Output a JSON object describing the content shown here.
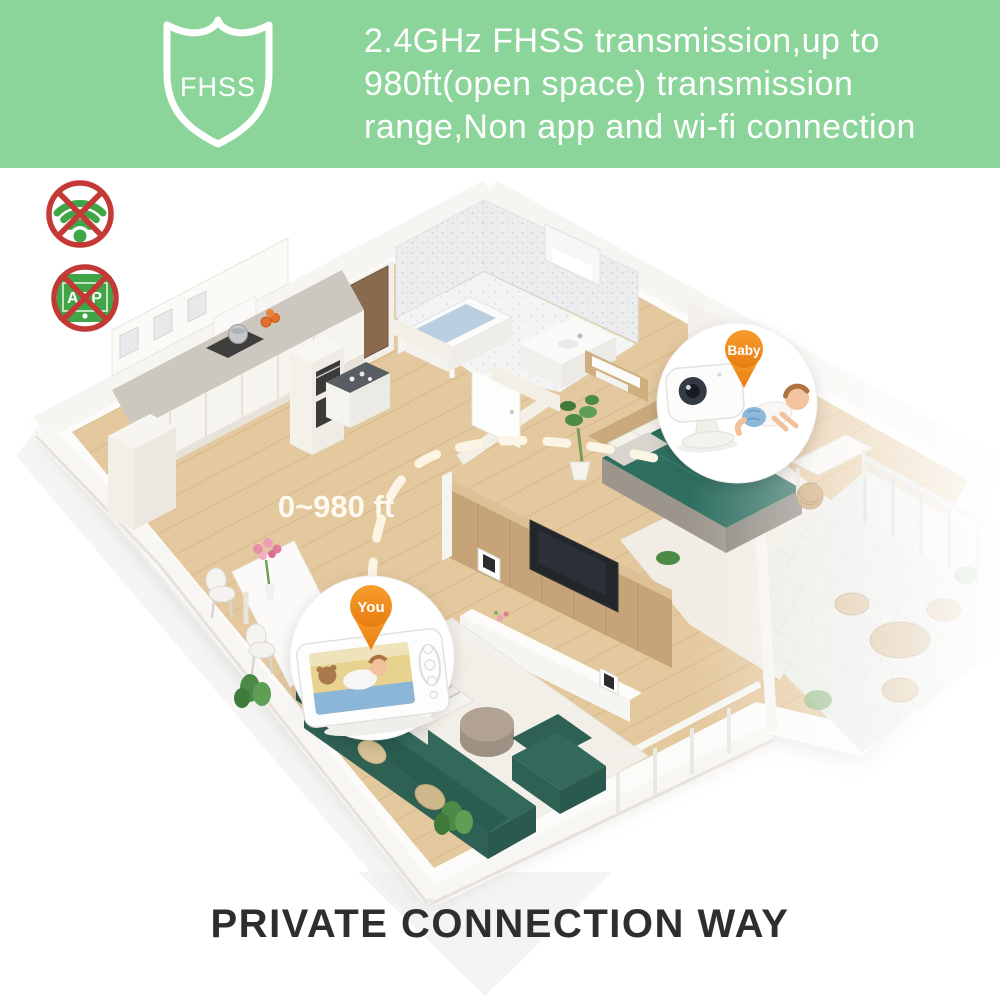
{
  "banner": {
    "bg_color": "#8bd49a",
    "text_color": "#ffffff",
    "shield_label": "FHSS",
    "line1": "2.4GHz FHSS transmission,up to",
    "line2": "980ft(open space) transmission",
    "line3": "range,Non app and wi-fi connection"
  },
  "restriction_icons": {
    "wifi_crossed": {
      "meaning": "no wi-fi connection",
      "icon_color": "#3fa547",
      "cross_color": "#c23936"
    },
    "app_crossed": {
      "label": "APP",
      "meaning": "no app connection",
      "icon_color": "#3fa547",
      "cross_color": "#c23936"
    }
  },
  "diagram": {
    "range_label": "0~980 ft",
    "dash_color": "#fcf4e4",
    "pin_color": "#ef8a1e",
    "baby_pin_label": "Baby",
    "you_pin_label": "You",
    "scene_palette": {
      "floor_wood": "#e4c89e",
      "wall_white": "#f7f5f1",
      "sofa_teal": "#33695b",
      "bed_teal": "#2e6f60",
      "tv_wall_wood": "#c6a478",
      "balcony_tile": "#e9ece6"
    }
  },
  "footer": {
    "title": "PRIVATE CONNECTION WAY",
    "text_color": "#2e2e2e"
  }
}
